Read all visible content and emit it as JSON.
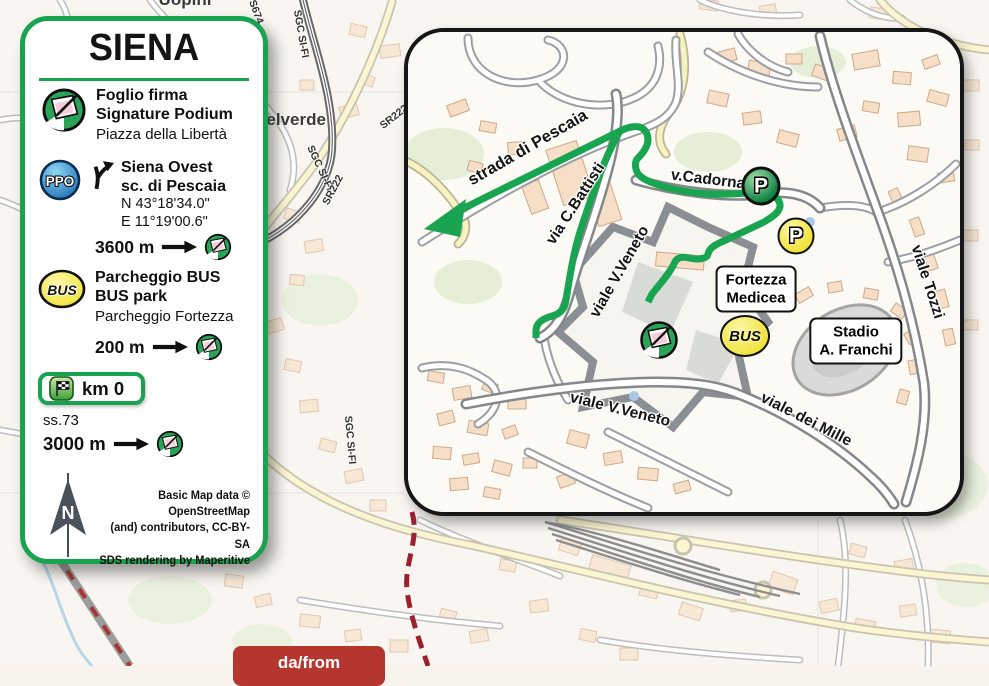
{
  "legend": {
    "title": "SIENA",
    "signature": {
      "title1": "Foglio firma",
      "title2": "Signature Podium",
      "subtitle": "Piazza della Libertà"
    },
    "ppo": {
      "badge": "PPO",
      "title1": "Siena Ovest",
      "title2": "sc. di Pescaia",
      "lat": "N  43°18'34.0\"",
      "lon": "E  11°19'00.6\"",
      "distance": "3600 m"
    },
    "bus": {
      "badge": "BUS",
      "title1": "Parcheggio BUS",
      "title2": "BUS park",
      "subtitle": "Parcheggio Fortezza",
      "distance": "200 m"
    },
    "km0": {
      "label": "km 0"
    },
    "ss73": {
      "road": "ss.73",
      "distance": "3000 m"
    },
    "north_letter": "N",
    "attribution": {
      "line1": "Basic Map data © OpenStreetMap",
      "line2": "(and) contributors, CC-BY-SA",
      "line3": "SDS rendering by Maperitive"
    }
  },
  "inset": {
    "streets": {
      "pescaia": "strada di Pescaia",
      "battisti": "via C.Battisti",
      "veneto_diag": "viale V.Veneto",
      "cadorna": "v.Cadorna",
      "veneto_bottom": "viale V.Veneto",
      "mille": "viale dei Mille",
      "tozzi": "viale Tozzi"
    },
    "pois": {
      "fortezza_line1": "Fortezza",
      "fortezza_line2": "Medicea",
      "stadio_line1": "Stadio",
      "stadio_line2": "A. Franchi",
      "parking": "P",
      "bus": "BUS"
    }
  },
  "background": {
    "labels": {
      "uopini": "Uopini",
      "belverde": "Belverde",
      "sgc": "SGC SI-FI",
      "sr222": "SR222",
      "s674": "S674"
    }
  },
  "badge": {
    "from_label": "da/from"
  },
  "colors": {
    "accent_green": "#19a351",
    "route_green": "#18a450",
    "badge_red": "#b5362f",
    "ppo_blue": "#1565ae",
    "bus_yellow": "#f0e134"
  }
}
